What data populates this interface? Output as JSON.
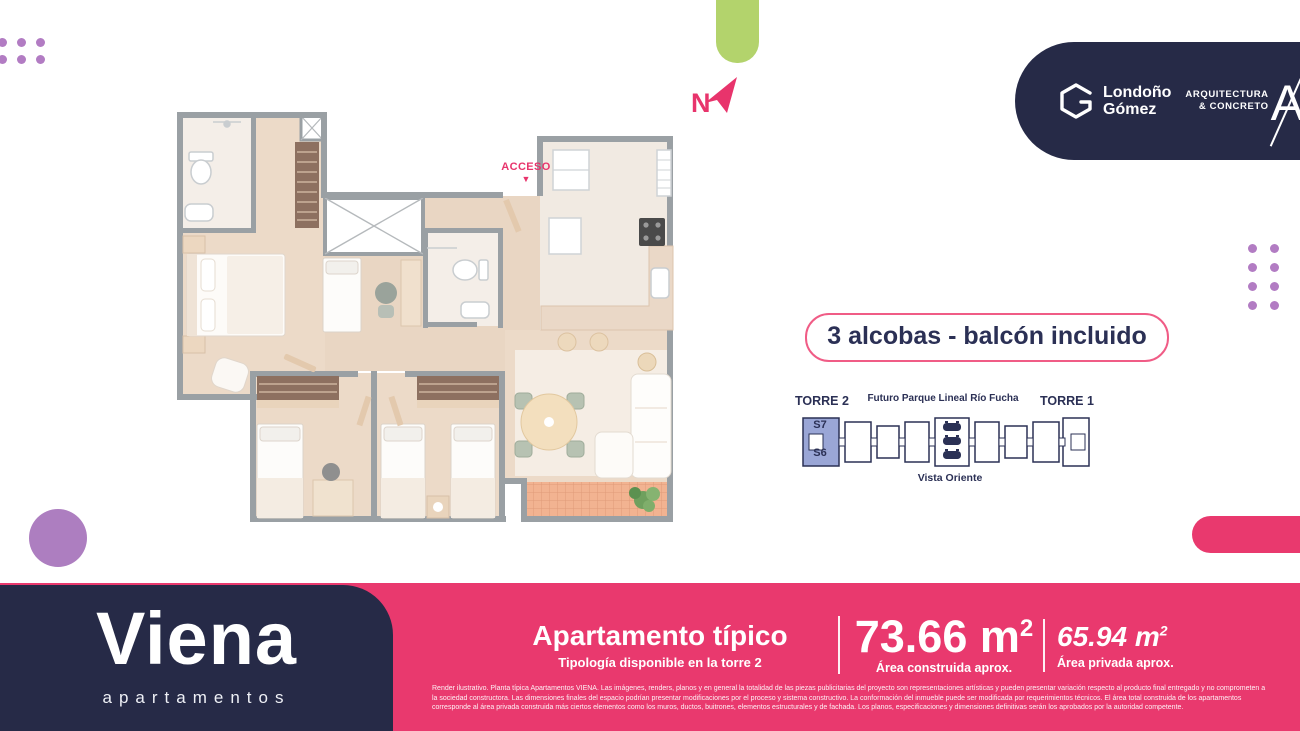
{
  "colors": {
    "navy": "#262a47",
    "pink": "#e9396e",
    "green": "#b3d36c",
    "purple": "#ad7ec0",
    "tower_highlight": "#9aa6d6"
  },
  "header": {
    "developer": {
      "name_line1": "Londoño",
      "name_line2": "Gómez"
    },
    "architect": {
      "line1": "ARQUITECTURA",
      "line2": "& CONCRETO",
      "monogram": "A"
    },
    "compass": {
      "label": "N"
    }
  },
  "plan": {
    "access_label": "ACCESO",
    "access_arrow": "▼"
  },
  "highlight_badge": {
    "label": "3 alcobas - balcón incluido"
  },
  "tower_diagram": {
    "torre2": "TORRE 2",
    "park": "Futuro Parque Lineal Río Fucha",
    "torre1": "TORRE 1",
    "vista": "Vista Oriente",
    "unit_top": "S7",
    "unit_bottom": "S6"
  },
  "footer": {
    "logo": {
      "name": "Viena",
      "tagline": "apartamentos"
    },
    "apartment": {
      "title": "Apartamento típico",
      "subtitle": "Tipología disponible en la torre 2"
    },
    "area_built": {
      "value": "73.66 m",
      "sup": "2",
      "caption": "Área construida aprox."
    },
    "area_private": {
      "value": "65.94 m",
      "sup": "2",
      "caption": "Área privada aprox."
    },
    "disclaimer": "Render ilustrativo. Planta típica Apartamentos VIENA. Las imágenes, renders, planos y en general la totalidad de las piezas publicitarias del proyecto son representaciones artísticas y pueden presentar variación respecto al producto final entregado y no comprometen a la sociedad constructora. Las dimensiones finales del espacio podrían presentar modificaciones por el proceso y sistema constructivo. La conformación del inmueble puede ser modificada por requerimientos técnicos. El área total construida de los apartamentos corresponde al área privada construida más ciertos elementos como los muros, ductos, buitrones, elementos estructurales y de fachada. Los planos, especificaciones y dimensiones definitivas serán los aprobados por la autoridad competente."
  }
}
